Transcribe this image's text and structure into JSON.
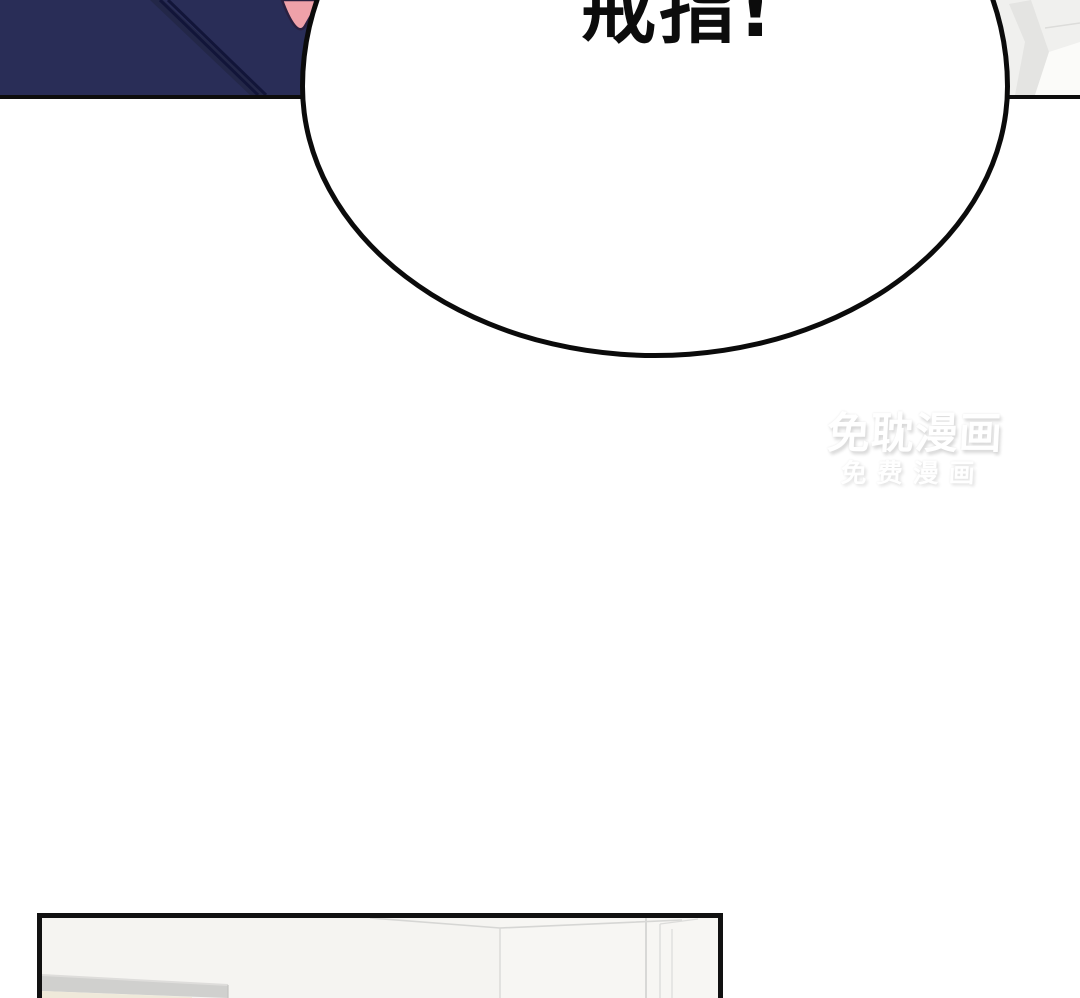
{
  "page": {
    "type": "webtoon-comic-page",
    "background_color": "#ffffff"
  },
  "speech_bubble": {
    "text": "戒指!",
    "text_color": "#0c0c0c",
    "fill_color": "#ffffff",
    "outline_color": "#0b0b0b"
  },
  "watermark": {
    "line1": "免耽漫画",
    "line2": "免费漫画",
    "text_color": "#ffffff",
    "shadow_color": "#d7d7d7"
  },
  "top_panel": {
    "border_color": "#0d0d0d",
    "jacket_color": "#292d57",
    "jacket_shade_color": "#232748",
    "jacket_seam_color": "#121539",
    "skin_color": "#efa1a9",
    "wall_color": "#f0f0ee",
    "wall_facet_color": "#e4e4e2",
    "wall_highlight_color": "#fbfbf9"
  },
  "bottom_panel": {
    "border_color": "#111111",
    "room_color": "#f6f5f2",
    "room_line_color": "#d6d6d4",
    "shelf_color": "#d0d0ce",
    "shelf_highlight_color": "#dedddb",
    "counter_color": "#efe9da"
  }
}
